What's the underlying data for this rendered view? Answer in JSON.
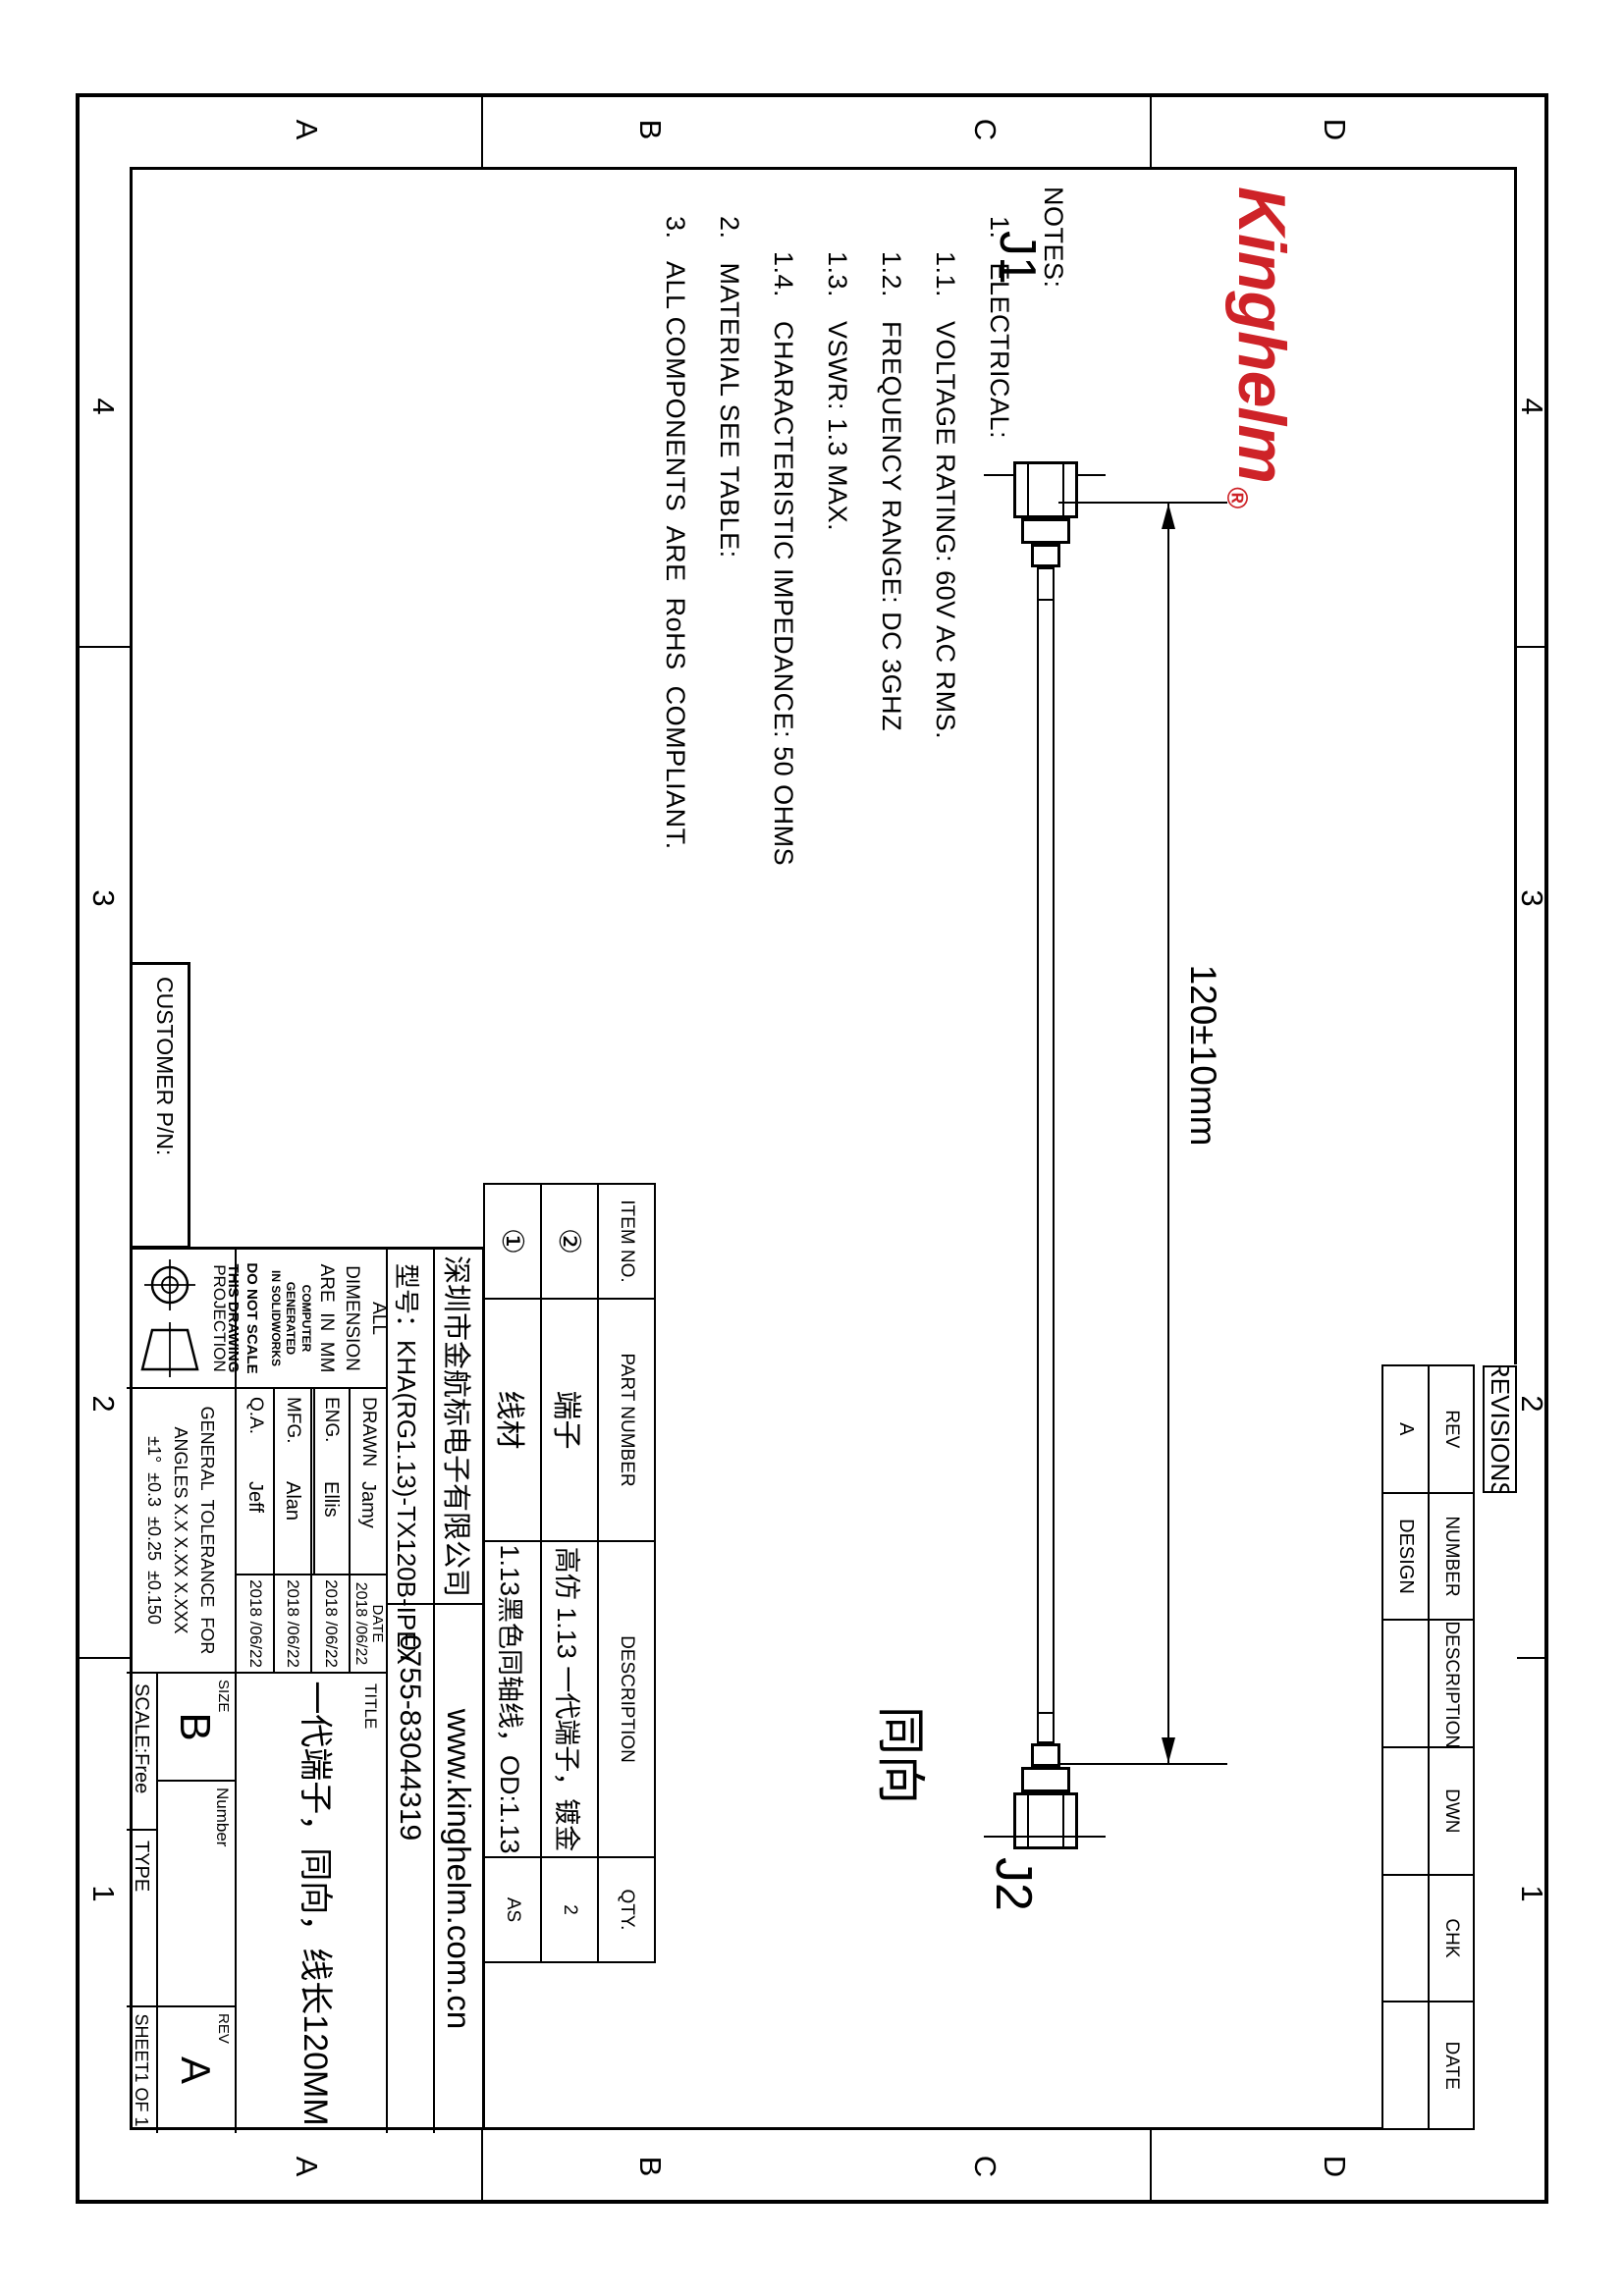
{
  "zones": {
    "top_numbers": [
      "4",
      "3",
      "2",
      "1"
    ],
    "bottom_numbers": [
      "4",
      "3",
      "2",
      "1"
    ],
    "left_letters": [
      "D",
      "C",
      "B",
      "A"
    ],
    "right_letters": [
      "D",
      "C",
      "B",
      "A"
    ]
  },
  "logo": {
    "text": "Kinghelm",
    "registered": "®",
    "color": "#ce2328"
  },
  "notes": {
    "lines": [
      "NOTES:",
      "1.   ELECTRICAL:",
      "1.1.   VOLTAGE RATING: 60V AC RMS.",
      "1.2.   FREQUENCY RANGE: DC 3GHZ",
      "1.3.   VSWR: 1.3 MAX.",
      "1.4.   CHARACTERISTIC IMPEDANCE: 50 OHMS",
      "2.   MATERIAL SEE TABLE:",
      "3.   ALL COMPONENTS  ARE  RoHS  COMPLIANT."
    ]
  },
  "drawing": {
    "j1_label": "J1",
    "j2_label": "J2",
    "dimension": "120±10mm",
    "direction_note": "同向"
  },
  "revisions": {
    "title": "REVISIONS",
    "headers": {
      "rev": "REV",
      "number": "NUMBER",
      "description": "DESCRIPTION",
      "dwn": "DWN",
      "chk": "CHK",
      "date": "DATE"
    },
    "row": {
      "rev": "A",
      "number": "DESIGN",
      "description": "",
      "dwn": "",
      "chk": "",
      "date": ""
    }
  },
  "bom": {
    "headers": {
      "item": "ITEM NO.",
      "part": "PART NUMBER",
      "desc": "DESCRIPTION",
      "qty": "QTY."
    },
    "rows": [
      {
        "item": "②",
        "part": "端子",
        "desc": "高仿 1.13 一代端子，镀金",
        "qty": "2"
      },
      {
        "item": "①",
        "part": "线材",
        "desc": "1.13黑色同轴线，OD:1.13",
        "qty": "AS"
      }
    ]
  },
  "title_block": {
    "company": "深圳市金航标电子有限公司",
    "website": "www.kinghelm.com.cn",
    "model": "型号：KHA(RG1.13)-TX120B-IPEX",
    "phone": "0755-83044319",
    "all_dim": "ALL  DIMENSION\nARE  IN  MM",
    "computer": "COMPUTER GENERATED\nIN SOLIDWORKS",
    "no_scale": "DO NOT SCALE\nTHIS DRAWING",
    "projection_label": "PROJECTION",
    "tolerance": "GENERAL  TOLERANCE  FOR\nANGLES X.X X.XX X.XXX\n±1°  ±0.3  ±0.25  ±0.150",
    "approvals": [
      {
        "role": "DRAWN",
        "name": "Jamy",
        "date_label": "DATE",
        "date": "2018 /06/22"
      },
      {
        "role": "ENG.",
        "name": "Ellis",
        "date": "2018 /06/22"
      },
      {
        "role": "MFG.",
        "name": "Alan",
        "date": "2018 /06/22"
      },
      {
        "role": "Q.A.",
        "name": "Jeff",
        "date": "2018 /06/22"
      }
    ],
    "title_label": "TITLE",
    "title": "一代端子，同向，线长120MM",
    "size_label": "SIZE",
    "size": "B",
    "number_label": "Number",
    "rev_label": "REV",
    "rev": "A",
    "scale": "SCALE:Free",
    "type_label": "TYPE",
    "sheet": "SHEET1 OF 1",
    "customer_pn": "CUSTOMER P/N:"
  }
}
